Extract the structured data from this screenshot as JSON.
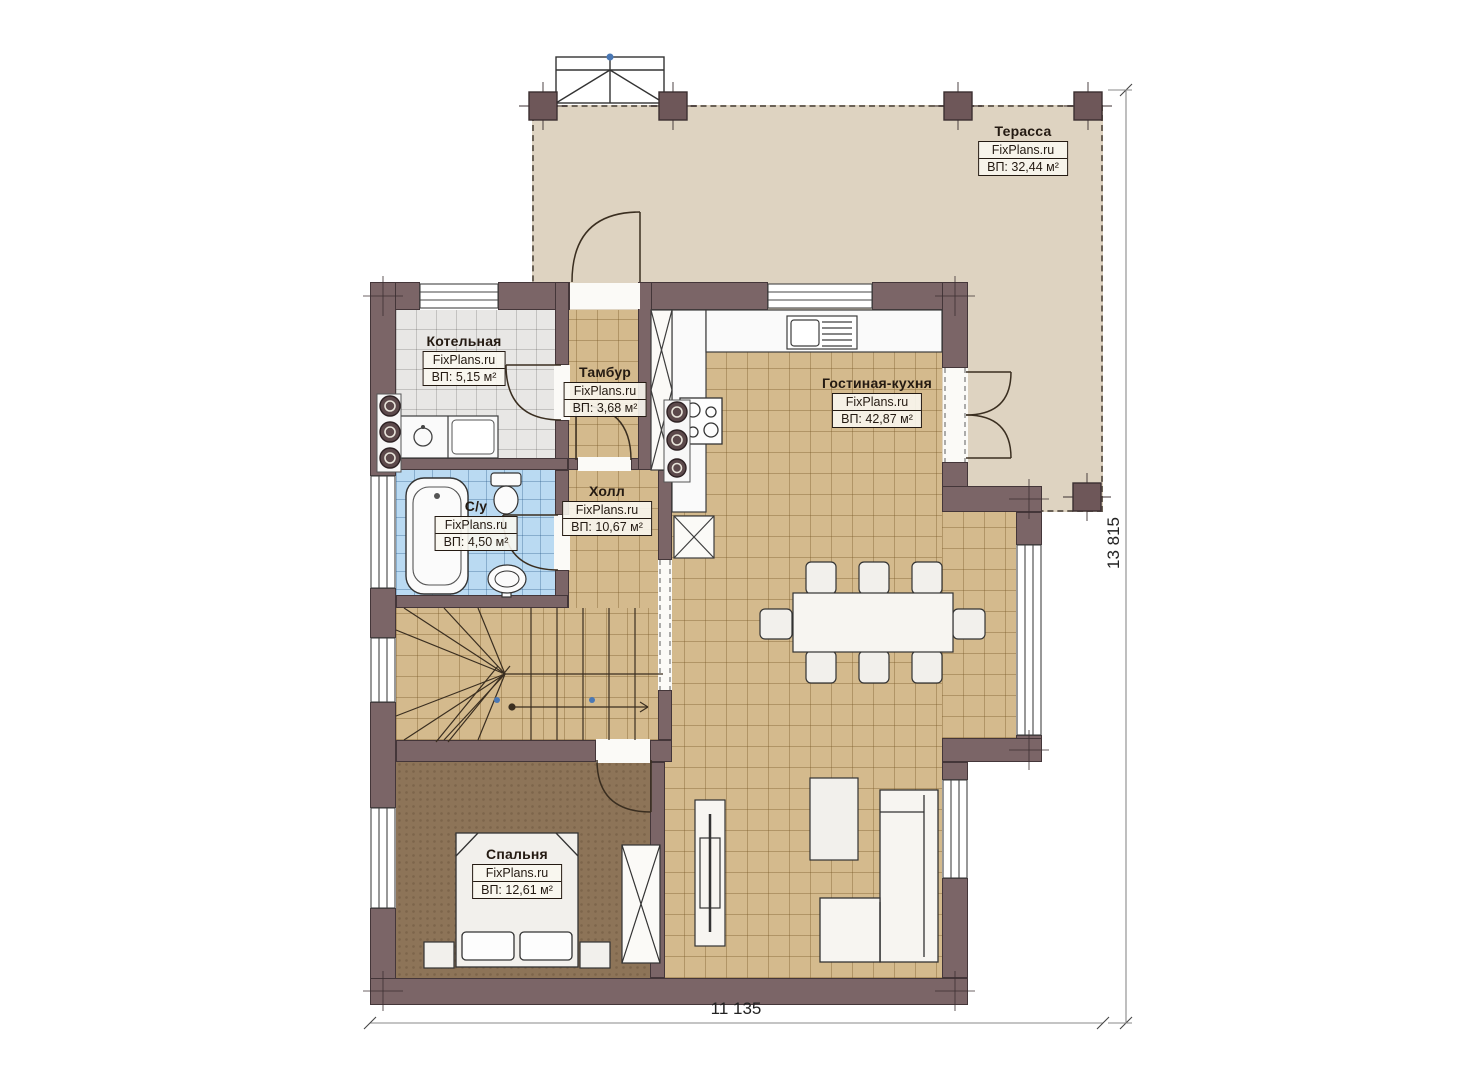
{
  "plan": {
    "brand": "FixPlans.ru",
    "rooms": [
      {
        "name": "Терасса",
        "watermark": "FixPlans.ru",
        "area": "ВП: 32,44 м²"
      },
      {
        "name": "Котельная",
        "watermark": "FixPlans.ru",
        "area": "ВП: 5,15 м²"
      },
      {
        "name": "Тамбур",
        "watermark": "FixPlans.ru",
        "area": "ВП: 3,68 м²"
      },
      {
        "name": "Гостиная-кухня",
        "watermark": "FixPlans.ru",
        "area": "ВП: 42,87 м²"
      },
      {
        "name": "С/у",
        "watermark": "FixPlans.ru",
        "area": "ВП: 4,50 м²"
      },
      {
        "name": "Холл",
        "watermark": "FixPlans.ru",
        "area": "ВП: 10,67 м²"
      },
      {
        "name": "Спальня",
        "watermark": "FixPlans.ru",
        "area": "ВП: 12,61 м²"
      }
    ],
    "dimensions": {
      "width_mm": "11 135",
      "height_mm": "13 815"
    },
    "colors": {
      "wall": "#7b6567",
      "terrace_floor": "#ded3c1",
      "tile_tan": "#d4ba8d",
      "tile_gray": "#e8e7e5",
      "tile_blue": "#badaf2",
      "bedroom_floor": "#8d7458"
    }
  }
}
